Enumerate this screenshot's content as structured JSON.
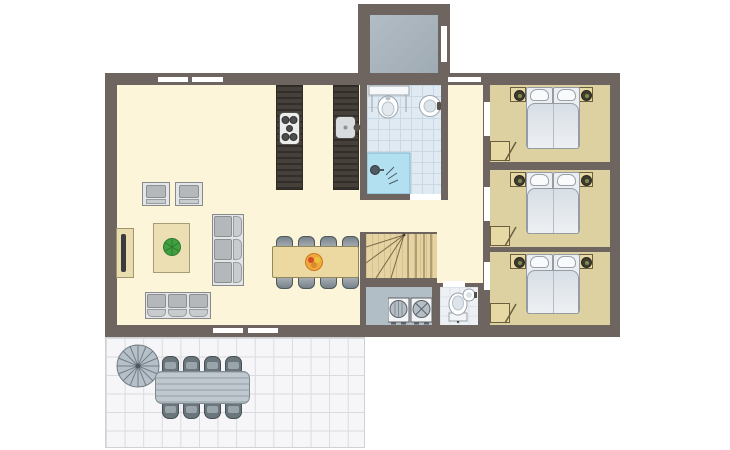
{
  "title": "holiday-home-floor-plan",
  "palette": {
    "wall": "#6E6561",
    "living_floor": "#FCF5D9",
    "bedroom_floor": "#DDD1A2",
    "bathroom_tile": "#E0EAF2",
    "wc_tile": "#EDF1F5",
    "shower_blue": "#B4E1F2",
    "porch_floor": "#A9B4BC",
    "utility_floor": "#B2BEC5",
    "stairs_wood": "#E6D3A2",
    "table_wood": "#ECD9A2",
    "kitchen_counter": "#403B37",
    "furniture_gray": "#B4B8BB",
    "terrace_tile": "#F6F6F8",
    "plant_green": "#41A041",
    "fruit_orange": "#F0A83C",
    "window_marker": "#FFFFFF"
  },
  "floorplan": {
    "rooms": [
      {
        "name": "entrance-porch",
        "furniture": []
      },
      {
        "name": "living-room",
        "furniture": [
          "armchair",
          "armchair",
          "coffee-table",
          "potted-plant",
          "sofa-3-seat-vertical",
          "sofa-3-seat-horizontal",
          "tv-cabinet",
          "tv",
          "dining-table",
          "fruit-bowl"
        ]
      },
      {
        "name": "kitchen",
        "furniture": [
          "counter-island",
          "stove-5-burner",
          "counter-island",
          "sink-with-faucet"
        ]
      },
      {
        "name": "bathroom",
        "furniture": [
          "vanity-counter",
          "toilet",
          "round-washbasin",
          "shower"
        ]
      },
      {
        "name": "hallway",
        "furniture": []
      },
      {
        "name": "staircase",
        "furniture": [
          "winder-stairs"
        ]
      },
      {
        "name": "utility-room",
        "furniture": [
          "washing-machine",
          "dryer"
        ]
      },
      {
        "name": "wc",
        "furniture": [
          "toilet",
          "round-washbasin"
        ]
      },
      {
        "name": "bedroom-1",
        "furniture": [
          "double-bed",
          "nightstand-with-lamp",
          "nightstand-with-lamp"
        ]
      },
      {
        "name": "bedroom-2",
        "furniture": [
          "double-bed",
          "nightstand-with-lamp",
          "nightstand-with-lamp"
        ]
      },
      {
        "name": "bedroom-3",
        "furniture": [
          "double-bed",
          "nightstand-with-lamp",
          "nightstand-with-lamp"
        ]
      },
      {
        "name": "terrace",
        "furniture": [
          "parasol",
          "outdoor-table",
          "outdoor-chair-x8"
        ]
      }
    ],
    "counts": {
      "bedrooms": 3,
      "beds_double": 3,
      "dining_chairs": 8,
      "outdoor_chairs": 8,
      "windows": 5,
      "interior_door_openings": 6
    }
  }
}
